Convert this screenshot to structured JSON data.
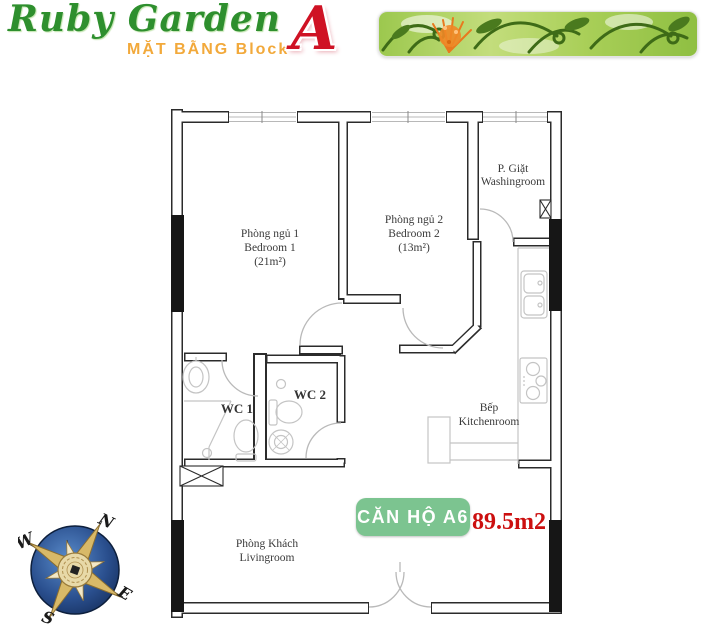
{
  "header": {
    "title": "Ruby Garden",
    "subtitle": "MẶT BẰNG Block",
    "block_letter": "A"
  },
  "colors": {
    "title_green": "#2e8f2e",
    "subtitle_orange": "#f2a93b",
    "block_letter_red": "#cf1224",
    "badge_green": "#7cc490",
    "area_red": "#cc0f0f",
    "wall_dark": "#2b2b2b",
    "banner_green": "#a9cf58"
  },
  "rooms": {
    "bedroom1": {
      "vi": "Phòng ngủ 1",
      "en": "Bedroom 1",
      "area": "(21m²)"
    },
    "bedroom2": {
      "vi": "Phòng ngủ 2",
      "en": "Bedroom 2",
      "area": "(13m²)"
    },
    "washingroom": {
      "vi": "P. Giặt",
      "en": "Washingroom"
    },
    "wc1": {
      "label": "WC 1"
    },
    "wc2": {
      "label": "WC 2"
    },
    "kitchen": {
      "vi": "Bếp",
      "en": "Kitchenroom"
    },
    "livingroom": {
      "vi": "Phòng Khách",
      "en": "Livingroom"
    }
  },
  "unit": {
    "badge": "CĂN HỘ A6",
    "area": "89.5m2"
  },
  "compass": {
    "north": "N",
    "east": "E",
    "south": "S",
    "west": "W"
  }
}
